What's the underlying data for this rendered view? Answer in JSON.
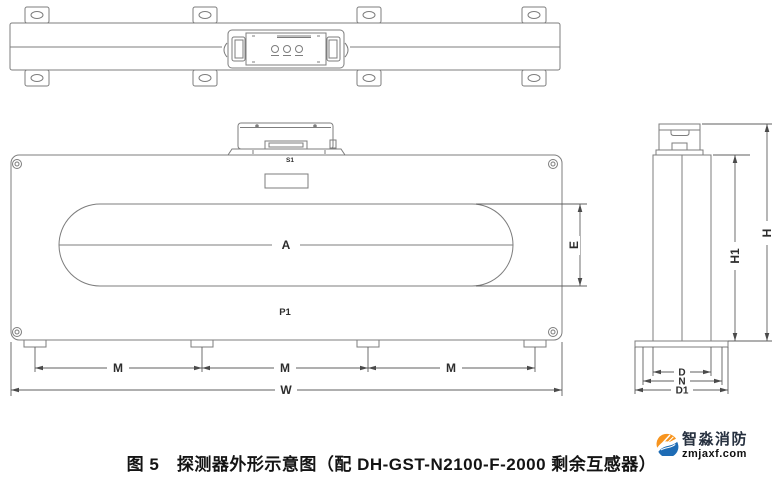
{
  "figure": {
    "caption": "图 5　探测器外形示意图（配 DH-GST-N2100-F-2000 剩余互感器）"
  },
  "drawing": {
    "labels": {
      "terminal": "S1",
      "slot": "A",
      "board": "P1",
      "slot_height": "E",
      "mount_spacing": "M",
      "overall_width": "W",
      "overall_height": "H",
      "body_height": "H1",
      "body_depth": "D",
      "mid_depth": "N",
      "base_depth": "D1"
    }
  },
  "logo": {
    "brand_name": "智淼消防",
    "website": "zmjaxf.com",
    "accent_orange": "#f7941e",
    "accent_blue": "#1e6cb5"
  }
}
